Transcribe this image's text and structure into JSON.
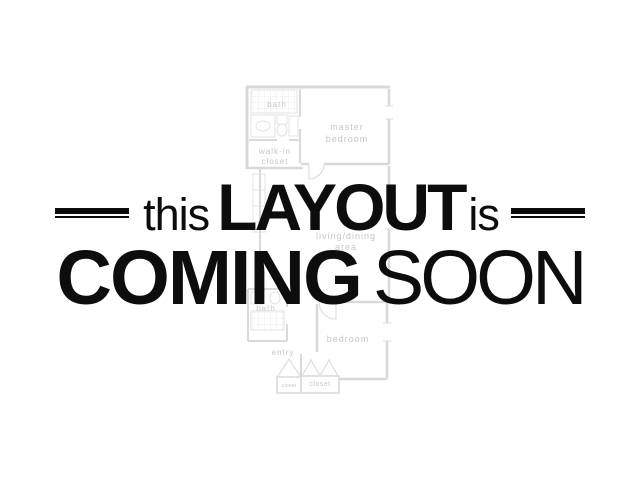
{
  "banner": {
    "line1": {
      "word_this": "this",
      "word_layout": "LAYOUT",
      "word_is": "is"
    },
    "line2": {
      "word_coming": "COMING",
      "word_soon": "SOON"
    }
  },
  "floorplan": {
    "rooms": {
      "bath_upper": "bath",
      "master_bedroom": [
        "master",
        "bedroom"
      ],
      "walk_in_closet": [
        "walk-in",
        "closet"
      ],
      "living_dining": [
        "living/dining",
        "area"
      ],
      "bath_lower": "bath",
      "bedroom": "bedroom",
      "entry": "entry",
      "closet_left": "closet",
      "closet_right": "closet"
    }
  },
  "colors": {
    "background": "#ffffff",
    "banner_text": "#0d0d0d",
    "plan_wall": "#d9d9d9",
    "plan_fixture": "#e3e3e3",
    "plan_label": "#c7c7c7"
  }
}
